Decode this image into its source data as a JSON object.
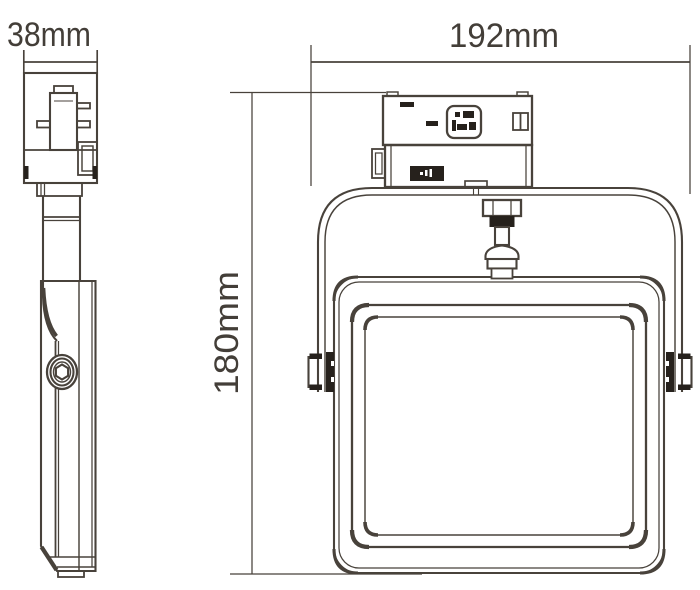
{
  "dimensions": {
    "side_width": "38mm",
    "front_width": "192mm",
    "front_height": "180mm"
  },
  "colors": {
    "line": "#48423b",
    "text": "#433e38",
    "fill_dark": "#26211c",
    "background": "#ffffff"
  }
}
